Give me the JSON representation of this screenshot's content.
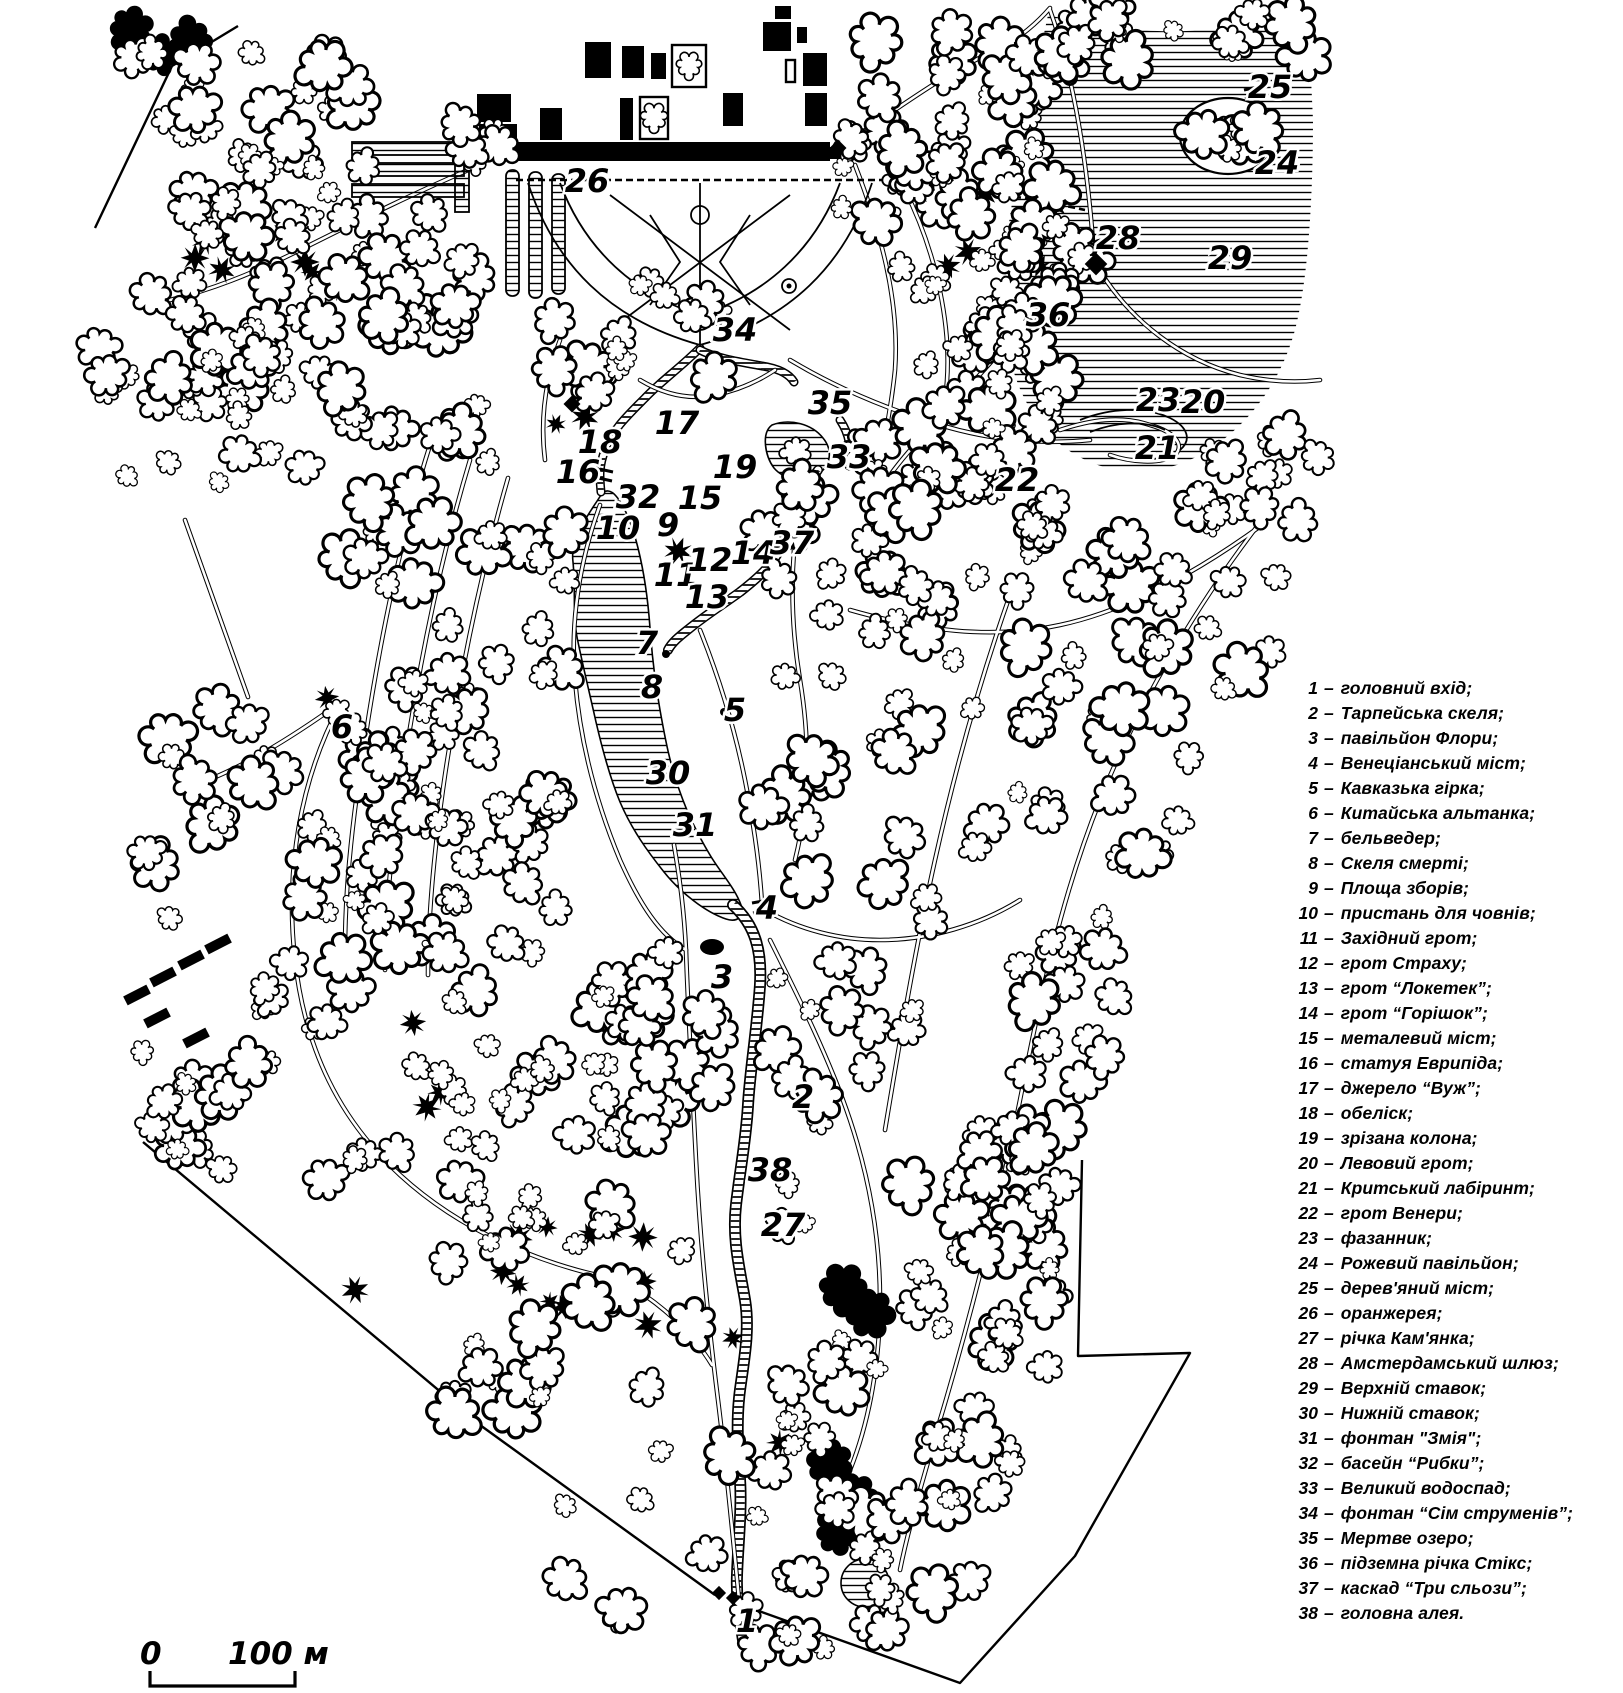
{
  "legend": {
    "dash": "–",
    "items": [
      {
        "num": "1",
        "label": "головний вхід;"
      },
      {
        "num": "2",
        "label": "Тарпейська скеля;"
      },
      {
        "num": "3",
        "label": "павільйон Флори;"
      },
      {
        "num": "4",
        "label": "Венеціанський міст;"
      },
      {
        "num": "5",
        "label": "Кавказька гірка;"
      },
      {
        "num": "6",
        "label": "Китайська альтанка;"
      },
      {
        "num": "7",
        "label": "бельведер;"
      },
      {
        "num": "8",
        "label": "Скеля смерті;"
      },
      {
        "num": "9",
        "label": "Площа зборів;"
      },
      {
        "num": "10",
        "label": "пристань для човнів;"
      },
      {
        "num": "11",
        "label": "Західний грот;"
      },
      {
        "num": "12",
        "label": "грот Страху;"
      },
      {
        "num": "13",
        "label": "грот “Локетек”;"
      },
      {
        "num": "14",
        "label": "грот “Горішок”;"
      },
      {
        "num": "15",
        "label": "металевий міст;"
      },
      {
        "num": "16",
        "label": "статуя Еврипіда;"
      },
      {
        "num": "17",
        "label": "джерело “Вуж”;"
      },
      {
        "num": "18",
        "label": "обеліск;"
      },
      {
        "num": "19",
        "label": "зрізана колона;"
      },
      {
        "num": "20",
        "label": "Левовий грот;"
      },
      {
        "num": "21",
        "label": "Критський лабіринт;"
      },
      {
        "num": "22",
        "label": "грот Венери;"
      },
      {
        "num": "23",
        "label": "фазанник;"
      },
      {
        "num": "24",
        "label": "Рожевий павільйон;"
      },
      {
        "num": "25",
        "label": "дерев'яний міст;"
      },
      {
        "num": "26",
        "label": "оранжерея;"
      },
      {
        "num": "27",
        "label": "річка Кам'янка;"
      },
      {
        "num": "28",
        "label": "Амстердамський шлюз;"
      },
      {
        "num": "29",
        "label": "Верхній ставок;"
      },
      {
        "num": "30",
        "label": "Нижній ставок;"
      },
      {
        "num": "31",
        "label": "фонтан \"Змія\";"
      },
      {
        "num": "32",
        "label": "басейн “Рибки”;"
      },
      {
        "num": "33",
        "label": "Великий водоспад;"
      },
      {
        "num": "34",
        "label": "фонтан “Сім струменів”;"
      },
      {
        "num": "35",
        "label": "Мертве озеро;"
      },
      {
        "num": "36",
        "label": "підземна річка Стікс;"
      },
      {
        "num": "37",
        "label": "каскад “Три сльози”;"
      },
      {
        "num": "38",
        "label": "головна алея."
      }
    ]
  },
  "scale_bar": {
    "zero": "0",
    "label": "100 м"
  },
  "map_labels": [
    {
      "n": "1",
      "x": 747,
      "y": 1632
    },
    {
      "n": "2",
      "x": 803,
      "y": 1108
    },
    {
      "n": "3",
      "x": 722,
      "y": 988
    },
    {
      "n": "4",
      "x": 767,
      "y": 919
    },
    {
      "n": "5",
      "x": 735,
      "y": 721
    },
    {
      "n": "6",
      "x": 342,
      "y": 738
    },
    {
      "n": "7",
      "x": 647,
      "y": 654
    },
    {
      "n": "8",
      "x": 652,
      "y": 698
    },
    {
      "n": "9",
      "x": 668,
      "y": 536
    },
    {
      "n": "10",
      "x": 618,
      "y": 539
    },
    {
      "n": "11",
      "x": 676,
      "y": 586
    },
    {
      "n": "12",
      "x": 710,
      "y": 571
    },
    {
      "n": "13",
      "x": 707,
      "y": 608
    },
    {
      "n": "14",
      "x": 753,
      "y": 564
    },
    {
      "n": "15",
      "x": 700,
      "y": 509
    },
    {
      "n": "16",
      "x": 578,
      "y": 483
    },
    {
      "n": "17",
      "x": 677,
      "y": 434
    },
    {
      "n": "18",
      "x": 600,
      "y": 453
    },
    {
      "n": "19",
      "x": 735,
      "y": 478
    },
    {
      "n": "20",
      "x": 1203,
      "y": 413
    },
    {
      "n": "21",
      "x": 1157,
      "y": 459
    },
    {
      "n": "22",
      "x": 1017,
      "y": 491
    },
    {
      "n": "23",
      "x": 1158,
      "y": 411
    },
    {
      "n": "24",
      "x": 1277,
      "y": 174
    },
    {
      "n": "25",
      "x": 1270,
      "y": 98
    },
    {
      "n": "26",
      "x": 587,
      "y": 192
    },
    {
      "n": "27",
      "x": 783,
      "y": 1236
    },
    {
      "n": "28",
      "x": 1118,
      "y": 249
    },
    {
      "n": "29",
      "x": 1230,
      "y": 269
    },
    {
      "n": "30",
      "x": 668,
      "y": 784
    },
    {
      "n": "31",
      "x": 695,
      "y": 836
    },
    {
      "n": "32",
      "x": 638,
      "y": 508
    },
    {
      "n": "33",
      "x": 849,
      "y": 468
    },
    {
      "n": "34",
      "x": 735,
      "y": 341
    },
    {
      "n": "35",
      "x": 830,
      "y": 414
    },
    {
      "n": "36",
      "x": 1048,
      "y": 326
    },
    {
      "n": "37",
      "x": 792,
      "y": 554
    },
    {
      "n": "38",
      "x": 770,
      "y": 1181
    }
  ]
}
